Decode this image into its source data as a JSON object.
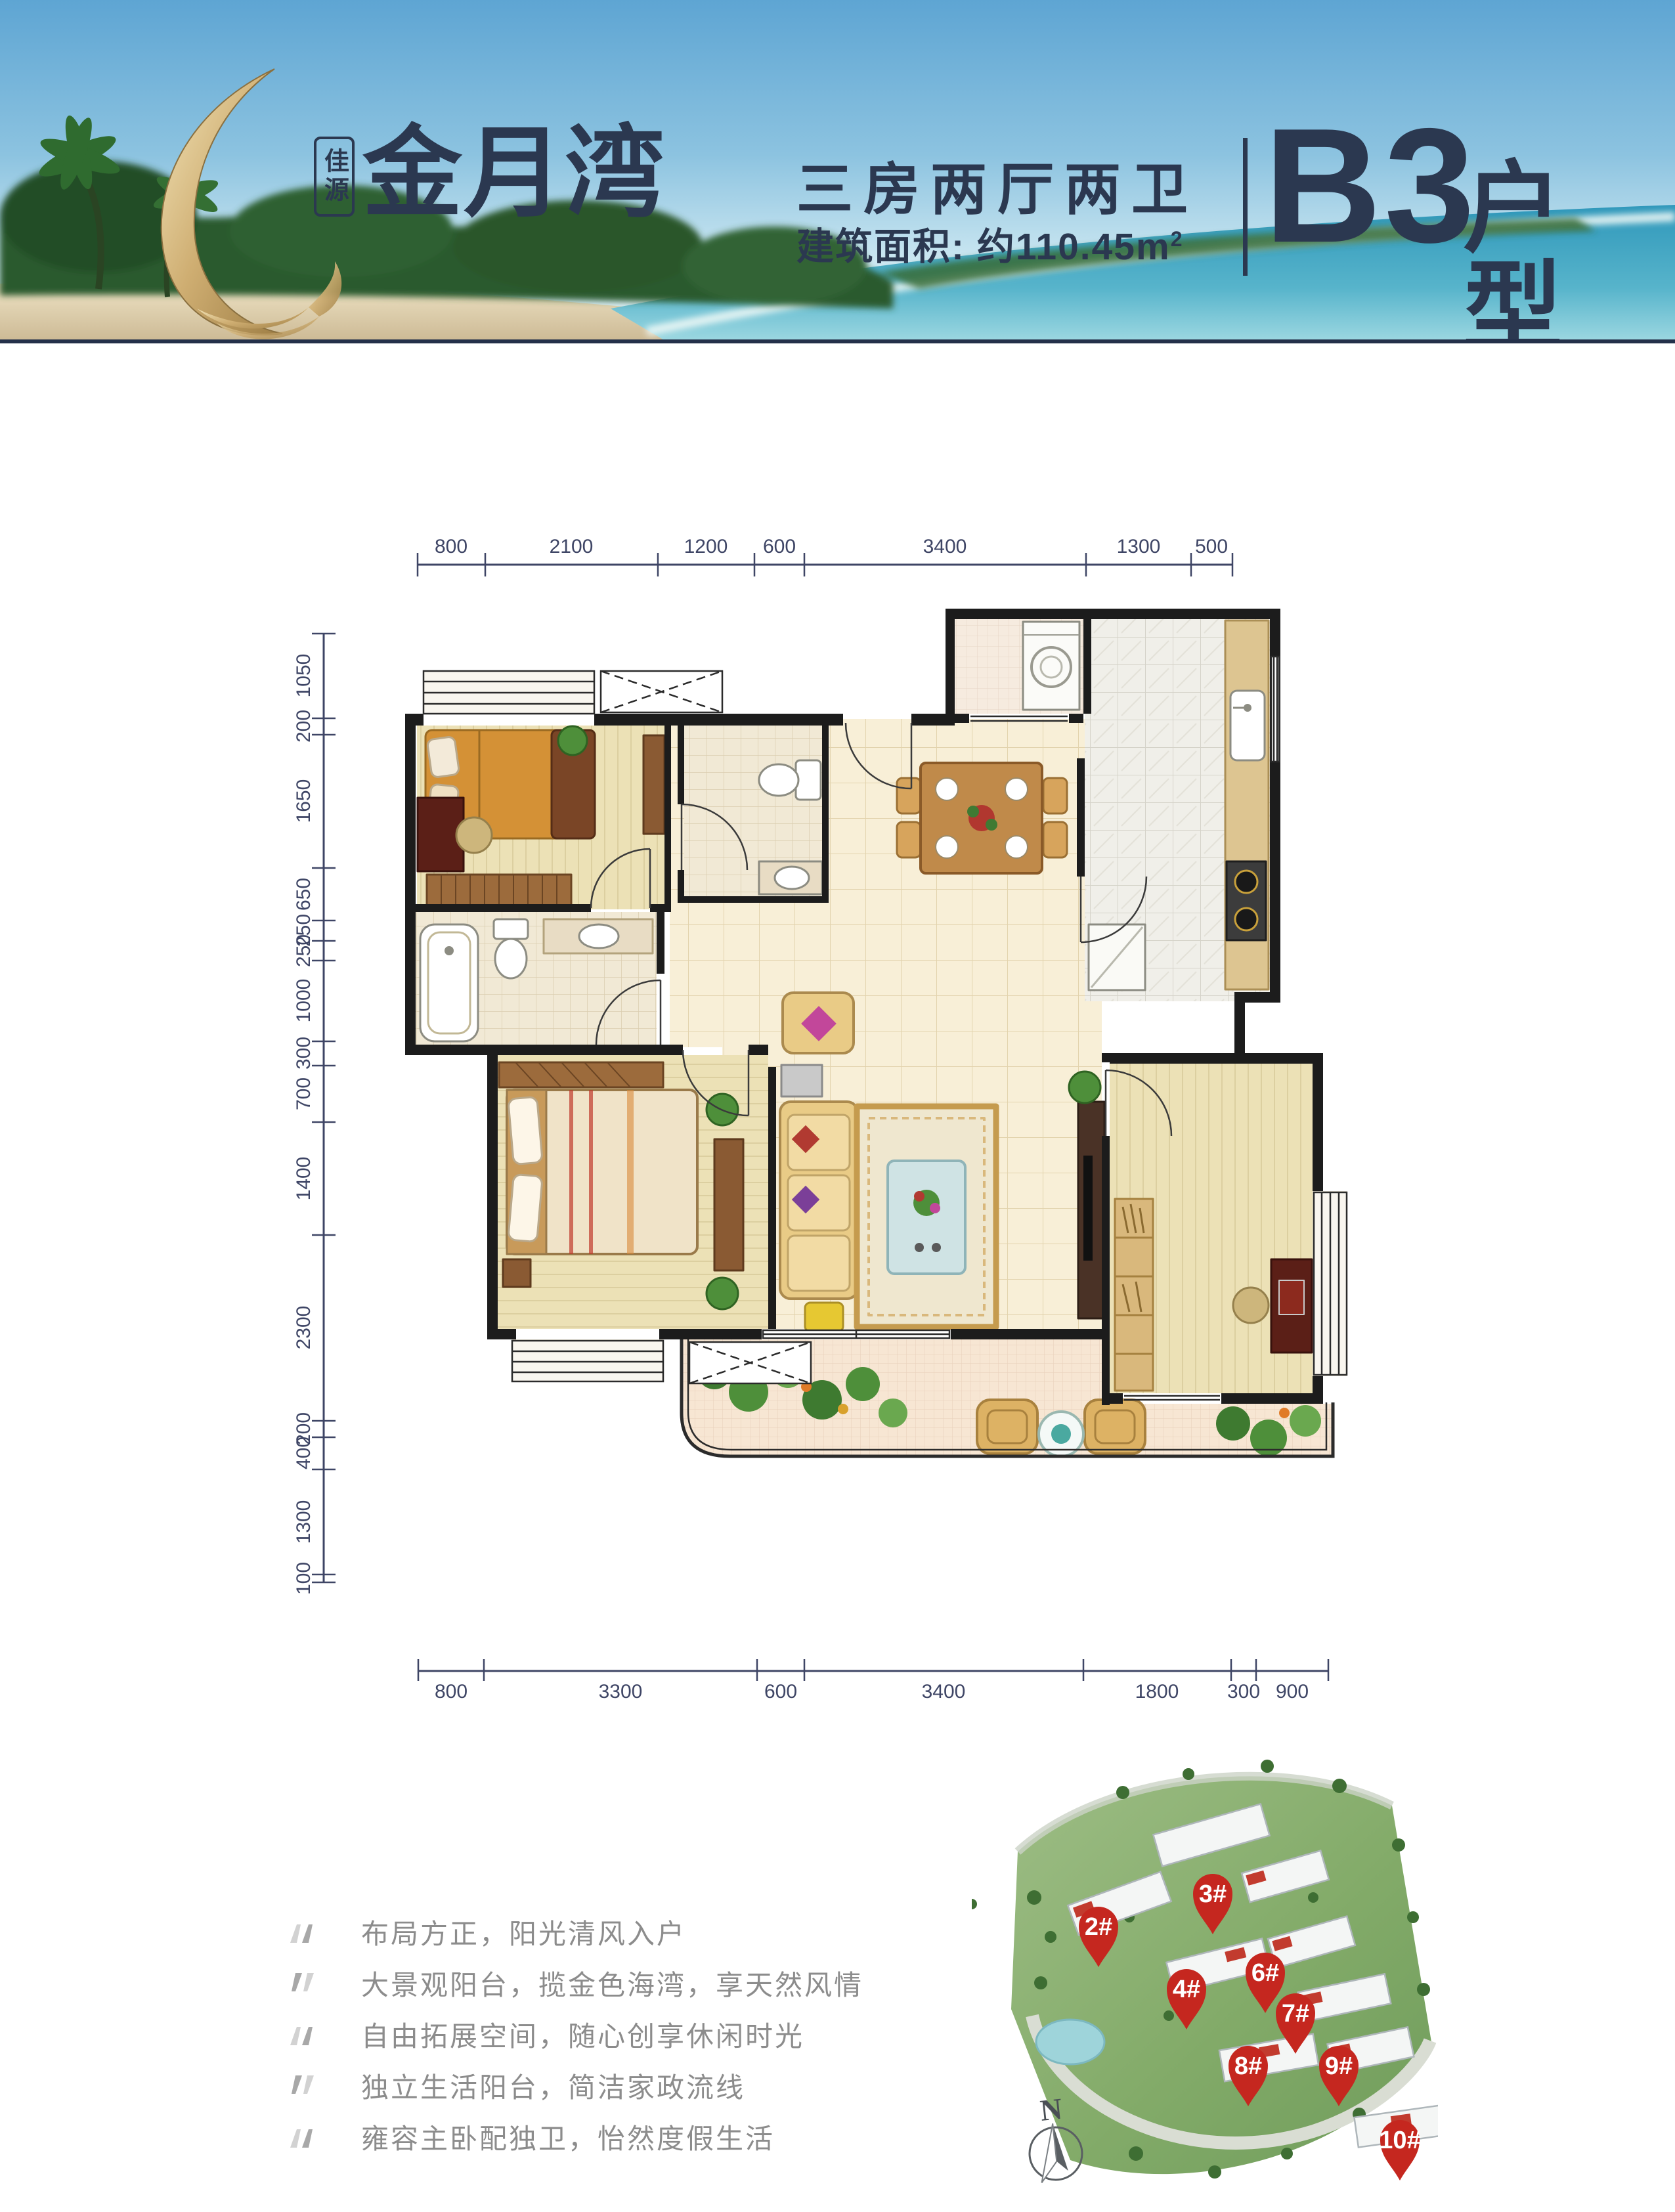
{
  "header": {
    "brand_badge": "佳源",
    "logo_text": "金月湾",
    "layout_title": "三房两厅两卫",
    "area_prefix": "建筑面积: 约110.45m",
    "area_sup": "2",
    "unit_code": "B3",
    "unit_type_label": "户型"
  },
  "floorplan": {
    "dims_top": [
      "800",
      "2100",
      "1200",
      "600",
      "3400",
      "1300",
      "500"
    ],
    "dims_bottom": [
      "800",
      "3300",
      "600",
      "3400",
      "1800",
      "300",
      "900"
    ],
    "dims_left": [
      "1050",
      "200",
      "1650",
      "650",
      "250",
      "250",
      "1000",
      "300",
      "700",
      "1400",
      "2300",
      "200",
      "400",
      "1300",
      "100"
    ]
  },
  "features": [
    {
      "text": "布局方正，阳光清风入户"
    },
    {
      "text": "大景观阳台，揽金色海湾，享天然风情"
    },
    {
      "text": "自由拓展空间，随心创享休闲时光"
    },
    {
      "text": "独立生活阳台，简洁家政流线"
    },
    {
      "text": "雍容主卧配独卫，怡然度假生活"
    }
  ],
  "siteplan": {
    "pins": [
      {
        "label": "2#"
      },
      {
        "label": "3#"
      },
      {
        "label": "4#"
      },
      {
        "label": "6#"
      },
      {
        "label": "7#"
      },
      {
        "label": "8#"
      },
      {
        "label": "9#"
      },
      {
        "label": "10#"
      }
    ],
    "compass_label": "N"
  },
  "colors": {
    "navy": "#2b3850",
    "dim_text": "#3e4565",
    "pin_red": "#c5271f",
    "feature_text": "#8c8c8c",
    "logo_gold": "#c9a863"
  }
}
